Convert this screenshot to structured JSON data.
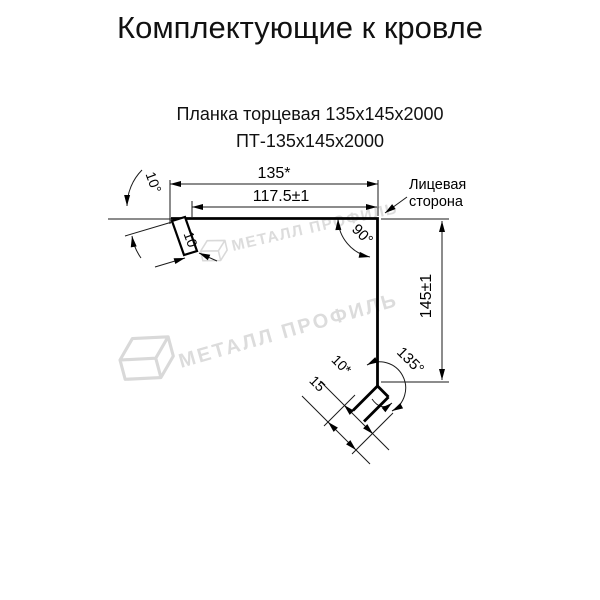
{
  "page": {
    "title": "Комплектующие к кровле",
    "subtitle_product": "Планка торцевая 135х145х2000",
    "subtitle_code": "ПТ-135х145х2000"
  },
  "drawing": {
    "dimensions": {
      "total_width": "135*",
      "face_width": "117.5±1",
      "height": "145±1",
      "top_left_angle": "10°",
      "corner_angle": "90°",
      "bottom_angle": "135°",
      "left_flange": "10",
      "bottom_hem": "10*",
      "bottom_kick": "15"
    },
    "face_note": {
      "line1": "Лицевая",
      "line2": "сторона"
    },
    "watermark": {
      "text": "МЕТАЛЛ ПРОФИЛЬ",
      "color": "#dcdcdc"
    },
    "colors": {
      "line": "#000000",
      "text": "#000000",
      "background": "#ffffff"
    }
  }
}
